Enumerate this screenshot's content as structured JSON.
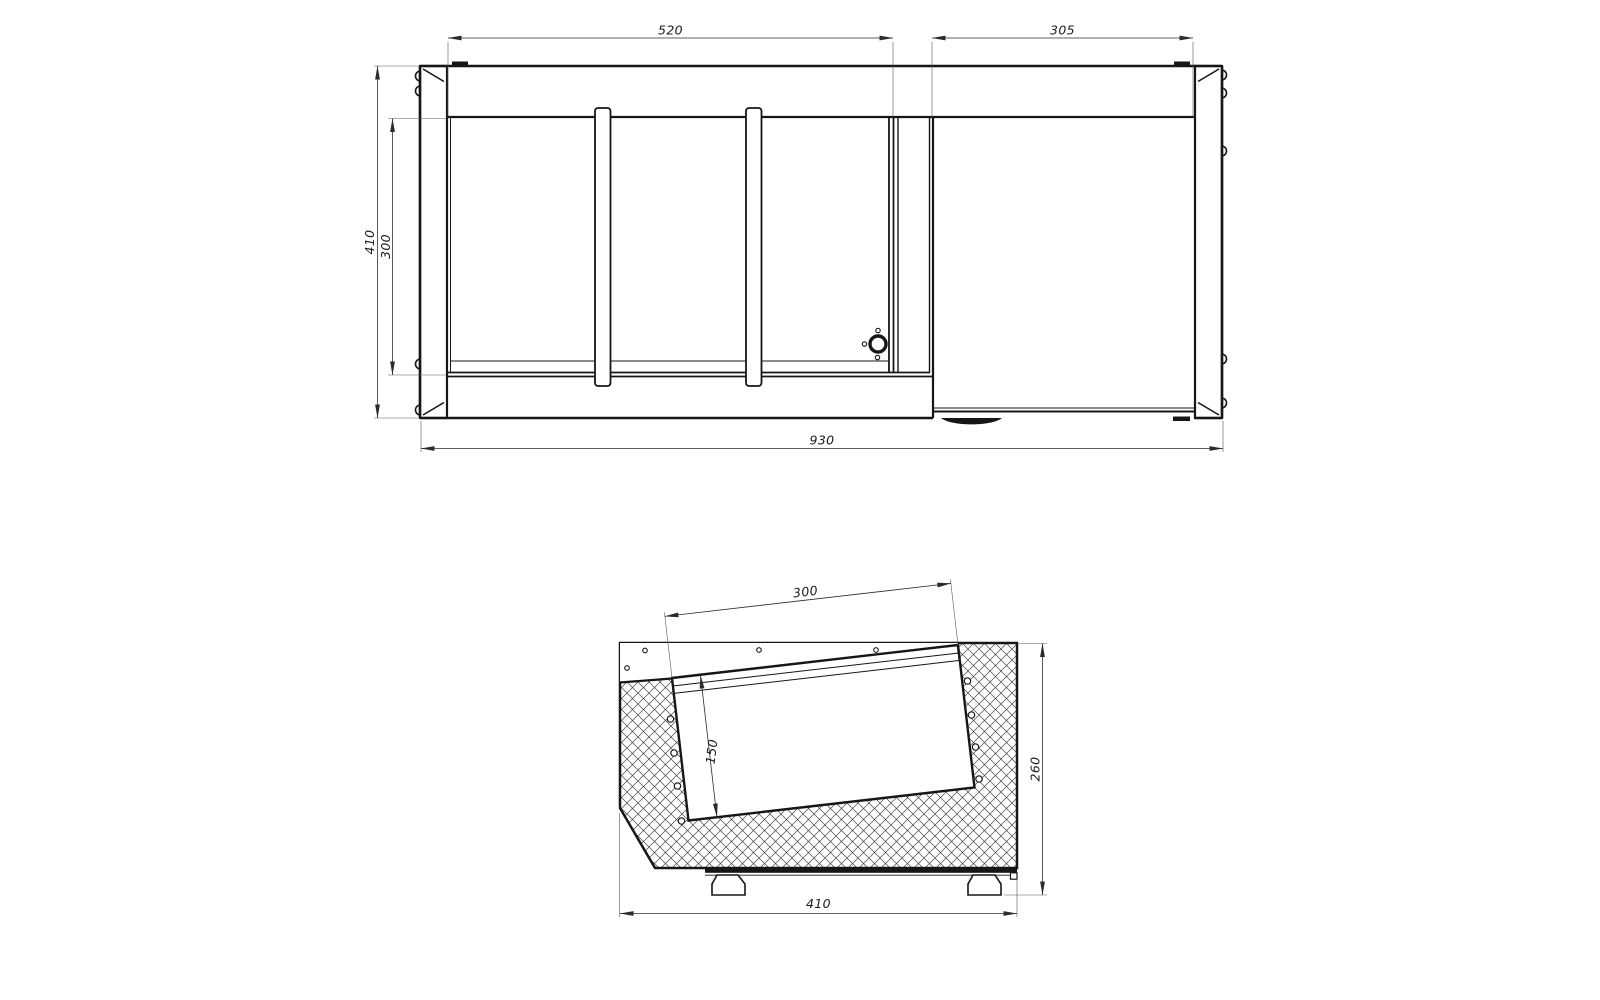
{
  "drawing": {
    "background": "#ffffff",
    "line_color": "#161616",
    "dimension_color": "#2b2b2b",
    "hatch_color": "#3f3f3f",
    "views": {
      "top": {
        "dims": {
          "left_section_width": "520",
          "right_section_width": "305",
          "overall_width": "930",
          "overall_depth": "410",
          "well_depth": "300"
        }
      },
      "side": {
        "dims": {
          "pan_length": "300",
          "pan_depth": "150",
          "overall_height": "260",
          "overall_depth": "410"
        }
      }
    }
  }
}
